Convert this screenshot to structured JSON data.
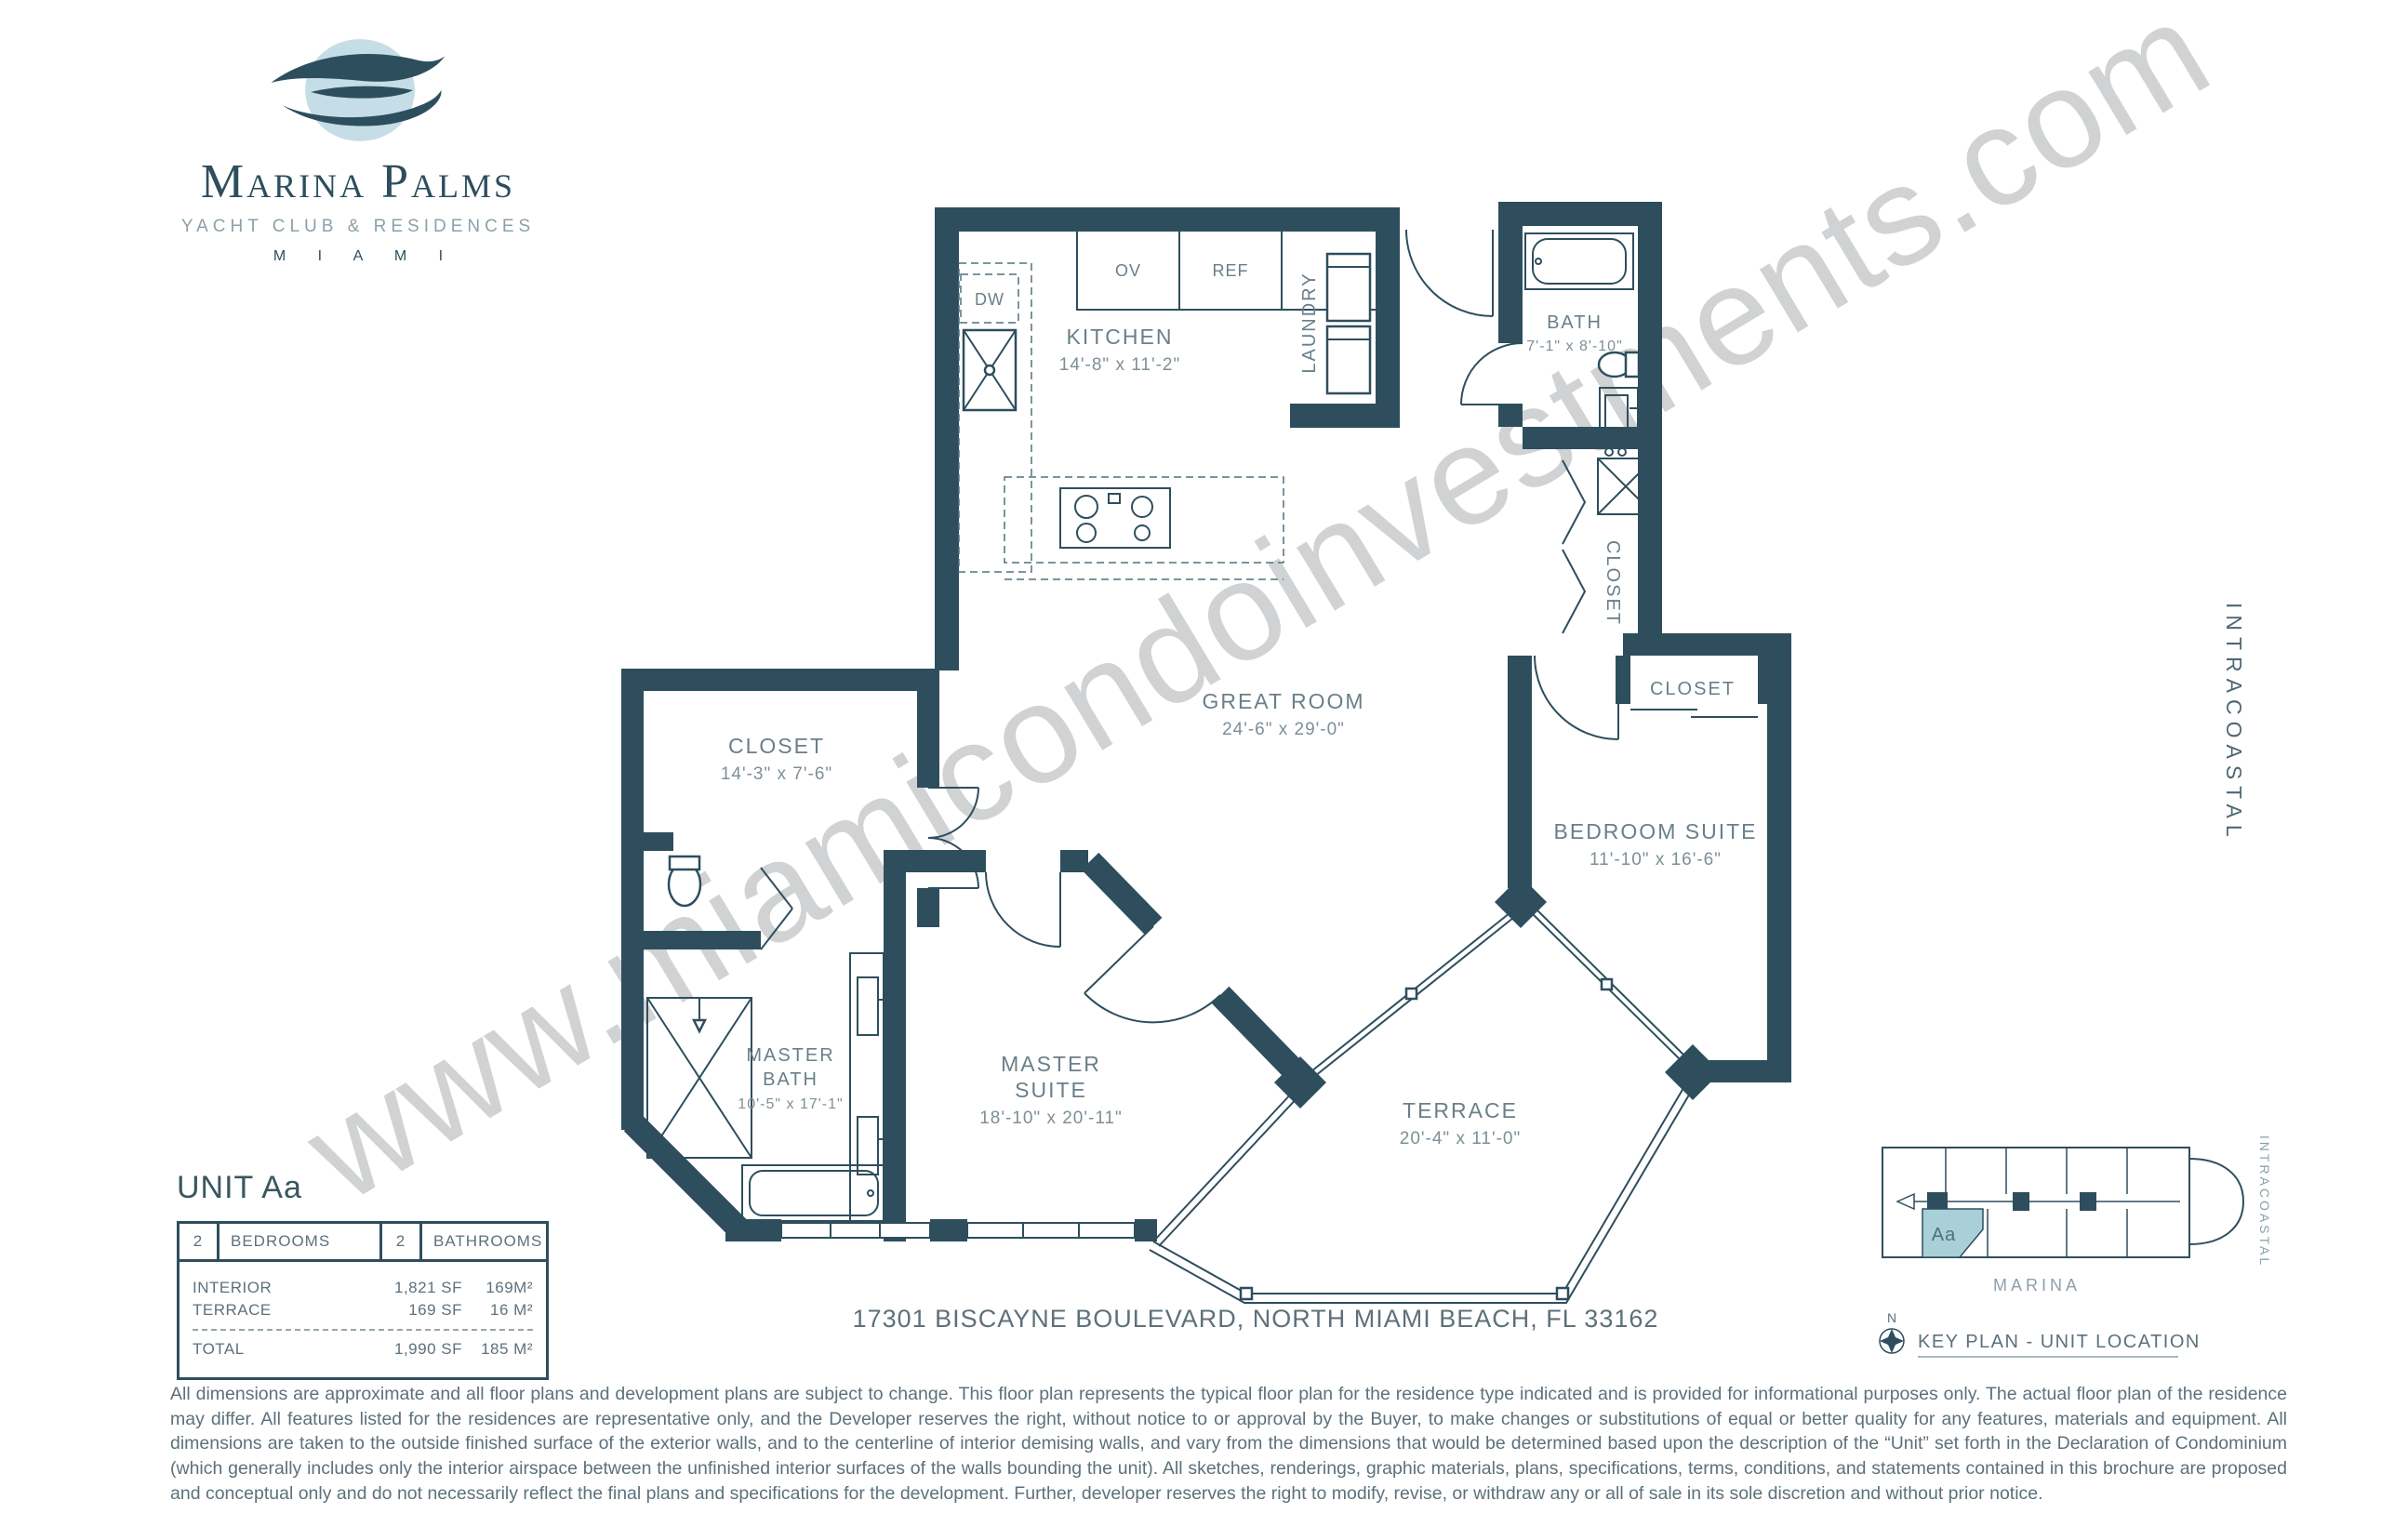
{
  "brand": {
    "name": "Marina Palms",
    "tagline": "YACHT CLUB & RESIDENCES",
    "city": "M I A M I"
  },
  "watermark": "www.miamicondoinvestments.com",
  "side_label": "INTRACOASTAL",
  "rooms": {
    "kitchen": {
      "name": "KITCHEN",
      "dims": "14'-8\" x 11'-2\""
    },
    "laundry": {
      "name": "LAUNDRY"
    },
    "bath": {
      "name": "BATH",
      "dims": "7'-1\" x 8'-10\""
    },
    "hall_closet": {
      "name": "CLOSET"
    },
    "bedroom_closet": {
      "name": "CLOSET"
    },
    "great_room": {
      "name": "GREAT ROOM",
      "dims": "24'-6\" x 29'-0\""
    },
    "bedroom_suite": {
      "name": "BEDROOM SUITE",
      "dims": "11'-10\" x 16'-6\""
    },
    "master_closet": {
      "name": "CLOSET",
      "dims": "14'-3\" x 7'-6\""
    },
    "master_bath": {
      "name_line1": "MASTER",
      "name_line2": "BATH",
      "dims": "10'-5\" x 17'-1\""
    },
    "master_suite": {
      "name_line1": "MASTER",
      "name_line2": "SUITE",
      "dims": "18'-10\" x 20'-11\""
    },
    "terrace": {
      "name": "TERRACE",
      "dims": "20'-4\" x 11'-0\""
    }
  },
  "appliances": {
    "ov": "OV",
    "ref": "REF",
    "dw": "DW"
  },
  "unit": {
    "title": "UNIT Aa",
    "beds_count": "2",
    "beds_label": "BEDROOMS",
    "baths_count": "2",
    "baths_label": "BATHROOMS",
    "rows": [
      {
        "label": "INTERIOR",
        "sf": "1,821 SF",
        "m2": "169M²"
      },
      {
        "label": "TERRACE",
        "sf": "169 SF",
        "m2": "16 M²"
      }
    ],
    "total": {
      "label": "TOTAL",
      "sf": "1,990 SF",
      "m2": "185 M²"
    }
  },
  "address": "17301 BISCAYNE BOULEVARD, NORTH MIAMI BEACH, FL 33162",
  "keyplan": {
    "title": "KEY PLAN - UNIT LOCATION",
    "marina_label": "MARINA",
    "intracoastal_label": "INTRACOASTAL",
    "north_label": "N",
    "unit_label": "Aa"
  },
  "disclaimer": "All dimensions are approximate and all floor plans and development plans are subject to change. This floor plan represents the typical floor plan for the residence type indicated and is provided for informational purposes only. The actual floor plan of the residence may differ. All features listed for the residences are representative only, and the Developer reserves the right, without notice to or approval by the Buyer, to make changes or substitutions of equal or better quality for any features, materials and equipment. All dimensions are taken to the outside finished surface of the exterior walls, and to the centerline of interior demising walls, and vary from the dimensions that would be determined based upon the description of the “Unit” set forth in the Declaration of Condominium (which generally includes only the interior airspace between the unfinished interior surfaces of the walls bounding the unit). All sketches, renderings, graphic materials, plans, specifications, terms, conditions, and statements contained in this brochure are proposed and conceptual only and do not necessarily reflect the final plans and specifications for the development. Further, developer reserves the right to modify, revise, or withdraw any or all of sale in its sole discretion and without prior notice.",
  "colors": {
    "wall": "#2e4e5e",
    "highlight": "#a9cfd9",
    "label": "#6a7f89"
  }
}
